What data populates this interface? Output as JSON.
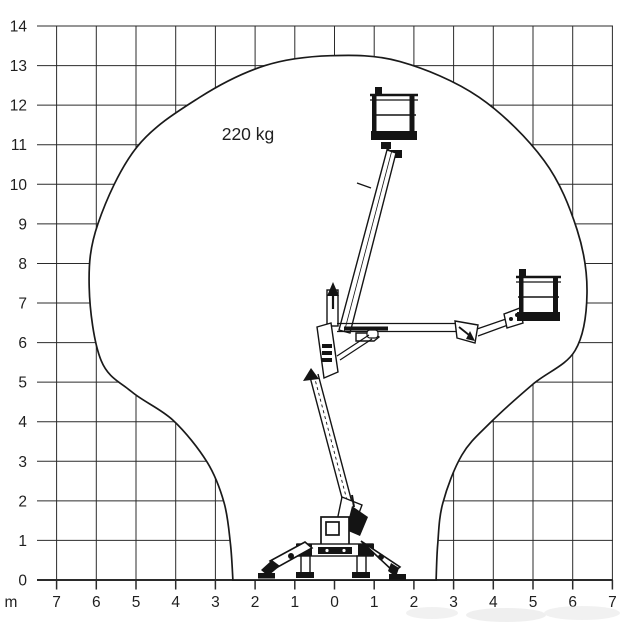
{
  "page": {
    "background": "#ffffff"
  },
  "chart_data": {
    "type": "area",
    "subtype": "working-envelope-diagram",
    "title": "",
    "annotation": "220 kg",
    "unit_label": "m",
    "xlabel": "m",
    "ylabel": "m",
    "grid": true,
    "xlim": [
      -7,
      7
    ],
    "ylim": [
      0,
      14
    ],
    "x_axis": {
      "tick_values": [
        -7,
        -6,
        -5,
        -4,
        -3,
        -2,
        -1,
        0,
        1,
        2,
        3,
        4,
        5,
        6,
        7
      ],
      "tick_labels": [
        "7",
        "6",
        "5",
        "4",
        "3",
        "2",
        "1",
        "0",
        "1",
        "2",
        "3",
        "4",
        "5",
        "6",
        "7"
      ]
    },
    "y_axis": {
      "tick_values": [
        0,
        1,
        2,
        3,
        4,
        5,
        6,
        7,
        8,
        9,
        10,
        11,
        12,
        13,
        14
      ],
      "tick_labels": [
        "0",
        "1",
        "2",
        "3",
        "4",
        "5",
        "6",
        "7",
        "8",
        "9",
        "10",
        "11",
        "12",
        "13",
        "14"
      ]
    },
    "envelope_series": {
      "name": "working-envelope",
      "max_height_m": 13.2,
      "max_side_reach_m": 6.4,
      "ground_half_width_m": 2.56,
      "points_m": [
        [
          -2.56,
          0.0
        ],
        [
          -2.62,
          0.9
        ],
        [
          -2.78,
          1.95
        ],
        [
          -3.21,
          2.98
        ],
        [
          -4.07,
          4.04
        ],
        [
          -5.1,
          4.75
        ],
        [
          -5.88,
          5.55
        ],
        [
          -6.18,
          7.4
        ],
        [
          -5.96,
          9.0
        ],
        [
          -4.97,
          10.95
        ],
        [
          -3.39,
          12.2
        ],
        [
          -1.75,
          13.0
        ],
        [
          -0.1,
          13.25
        ],
        [
          1.65,
          13.1
        ],
        [
          3.64,
          12.2
        ],
        [
          5.28,
          10.6
        ],
        [
          6.11,
          8.85
        ],
        [
          6.36,
          7.25
        ],
        [
          6.06,
          5.8
        ],
        [
          5.0,
          4.95
        ],
        [
          3.92,
          3.97
        ],
        [
          3.21,
          3.16
        ],
        [
          2.73,
          1.95
        ],
        [
          2.6,
          0.9
        ],
        [
          2.56,
          0.0
        ]
      ]
    },
    "pictogram": "articulated spider boom lift: platform shown raised to ~12 m above base and extended sideways to ~5.6 m at ~7 m height"
  },
  "colors": {
    "background": "#ffffff",
    "grid_line": "#2b2b2b",
    "envelope_line": "#1a1a1a",
    "machine": "#141414",
    "label": "#1f1f1f",
    "watermark": "#e2e2e2"
  }
}
